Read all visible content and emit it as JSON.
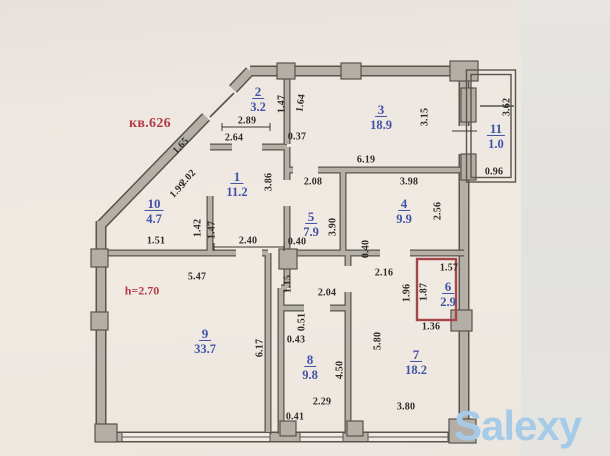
{
  "apartment": {
    "label": "кв.626",
    "ceiling_height": "h=2.70"
  },
  "watermark": "Salexy",
  "colors": {
    "paper": "#efe9e2",
    "photo_edge": "#e2e1dd",
    "wall_fill": "#b4b0a8",
    "wall_line": "#57544c",
    "room_text": "#4152a6",
    "red_text": "#b23b45",
    "red_wall": "#a54449",
    "dim_text": "#2f2b26",
    "watermark_color": "#a6cbe8"
  },
  "rooms": [
    {
      "number": "1",
      "area": "11.2",
      "x": 237,
      "y": 184
    },
    {
      "number": "2",
      "area": "3.2",
      "x": 258,
      "y": 99
    },
    {
      "number": "3",
      "area": "18.9",
      "x": 381,
      "y": 117
    },
    {
      "number": "4",
      "area": "9.9",
      "x": 404,
      "y": 211
    },
    {
      "number": "5",
      "area": "7.9",
      "x": 311,
      "y": 224
    },
    {
      "number": "6",
      "area": "2.9",
      "x": 448,
      "y": 294
    },
    {
      "number": "7",
      "area": "18.2",
      "x": 416,
      "y": 362
    },
    {
      "number": "8",
      "area": "9.8",
      "x": 310,
      "y": 367
    },
    {
      "number": "9",
      "area": "33.7",
      "x": 205,
      "y": 341
    },
    {
      "number": "10",
      "area": "4.7",
      "x": 154,
      "y": 211
    },
    {
      "number": "11",
      "area": "1.0",
      "x": 496,
      "y": 136
    }
  ],
  "dimensions": [
    {
      "value": "2.89",
      "x": 247,
      "y": 121,
      "rot": 0
    },
    {
      "value": "2.64",
      "x": 234,
      "y": 138,
      "rot": 0
    },
    {
      "value": "0.37",
      "x": 297,
      "y": 137,
      "rot": 0
    },
    {
      "value": "6.19",
      "x": 366,
      "y": 160,
      "rot": 0
    },
    {
      "value": "0.96",
      "x": 494,
      "y": 172,
      "rot": 0
    },
    {
      "value": "2.08",
      "x": 313,
      "y": 182,
      "rot": 0
    },
    {
      "value": "3.98",
      "x": 409,
      "y": 182,
      "rot": 0
    },
    {
      "value": "1.51",
      "x": 156,
      "y": 241,
      "rot": 0
    },
    {
      "value": "2.40",
      "x": 248,
      "y": 241,
      "rot": 0
    },
    {
      "value": "0.40",
      "x": 297,
      "y": 242,
      "rot": 0
    },
    {
      "value": "5.47",
      "x": 197,
      "y": 277,
      "rot": 0
    },
    {
      "value": "2.16",
      "x": 384,
      "y": 273,
      "rot": 0
    },
    {
      "value": "1.57",
      "x": 449,
      "y": 268,
      "rot": 0
    },
    {
      "value": "2.04",
      "x": 327,
      "y": 293,
      "rot": 0
    },
    {
      "value": "1.36",
      "x": 431,
      "y": 327,
      "rot": 0
    },
    {
      "value": "0.43",
      "x": 296,
      "y": 340,
      "rot": 0
    },
    {
      "value": "2.29",
      "x": 322,
      "y": 402,
      "rot": 0
    },
    {
      "value": "3.80",
      "x": 406,
      "y": 407,
      "rot": 0
    },
    {
      "value": "0.41",
      "x": 295,
      "y": 417,
      "rot": 0
    },
    {
      "value": "1.47",
      "x": 282,
      "y": 104,
      "rot": -90
    },
    {
      "value": "1.64",
      "x": 301,
      "y": 103,
      "rot": -82
    },
    {
      "value": "3.15",
      "x": 425,
      "y": 117,
      "rot": -90
    },
    {
      "value": "3.62",
      "x": 507,
      "y": 107,
      "rot": -90
    },
    {
      "value": "3.86",
      "x": 269,
      "y": 182,
      "rot": -90
    },
    {
      "value": "3.90",
      "x": 333,
      "y": 227,
      "rot": -90
    },
    {
      "value": "2.56",
      "x": 438,
      "y": 211,
      "rot": -90
    },
    {
      "value": "0.40",
      "x": 366,
      "y": 249,
      "rot": -90
    },
    {
      "value": "1.42",
      "x": 198,
      "y": 228,
      "rot": -90
    },
    {
      "value": "1.47",
      "x": 212,
      "y": 230,
      "rot": -90
    },
    {
      "value": "1.15",
      "x": 288,
      "y": 284,
      "rot": -90
    },
    {
      "value": "0.51",
      "x": 302,
      "y": 322,
      "rot": -90
    },
    {
      "value": "1.87",
      "x": 424,
      "y": 292,
      "rot": -90
    },
    {
      "value": "1.96",
      "x": 407,
      "y": 293,
      "rot": -90
    },
    {
      "value": "5.80",
      "x": 378,
      "y": 341,
      "rot": -90
    },
    {
      "value": "4.50",
      "x": 340,
      "y": 370,
      "rot": -90
    },
    {
      "value": "6.17",
      "x": 260,
      "y": 348,
      "rot": -90
    },
    {
      "value": "1.65",
      "x": 181,
      "y": 146,
      "rot": -46
    },
    {
      "value": "2.02",
      "x": 188,
      "y": 178,
      "rot": -46
    },
    {
      "value": "1.99",
      "x": 178,
      "y": 190,
      "rot": -46
    }
  ]
}
